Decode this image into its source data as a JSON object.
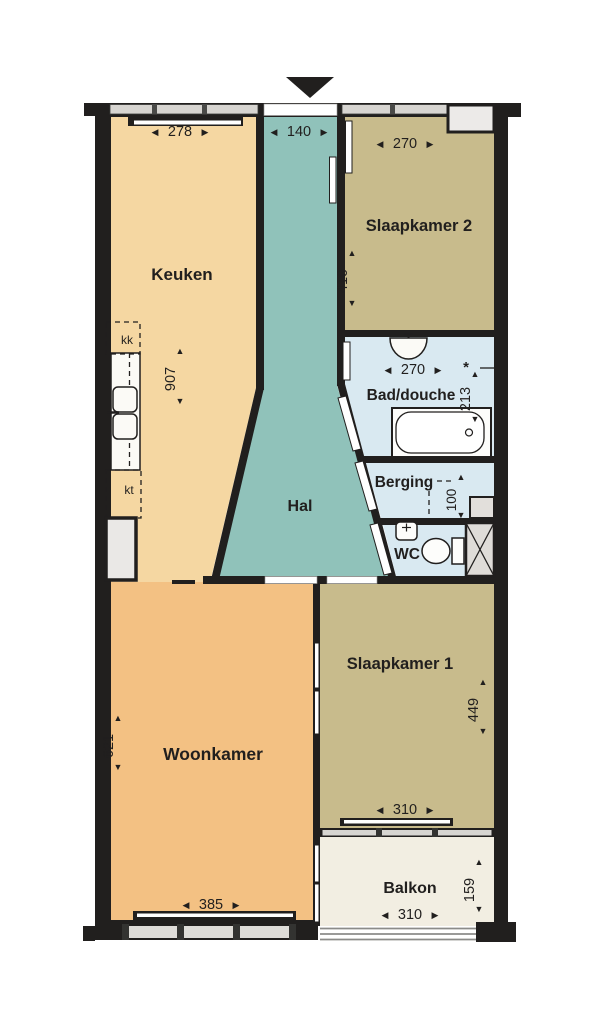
{
  "plan_type": "apartment-floor-plan",
  "arrows": {
    "left": "◀",
    "right": "▶",
    "up": "▲",
    "down": "▼"
  },
  "colors": {
    "wall": "#211f1e",
    "keuken": "#f5d7a2",
    "woonkamer": "#f3c183",
    "slaapkamer": "#c8bb8c",
    "hal": "#90c2ba",
    "wet": "#d9e9f1",
    "balkon": "#f2eee2",
    "window_band": "#d7d5d1",
    "recess": "#eceae8",
    "shaft": "#dfdcd8"
  },
  "rooms": {
    "keuken": {
      "label": "Keuken",
      "width": "278",
      "depth": "907",
      "unit_top": "kk",
      "unit_bottom": "kt"
    },
    "hal": {
      "label": "Hal",
      "width": "140"
    },
    "slaapkamer2": {
      "label": "Slaapkamer 2",
      "width": "270",
      "depth": "410"
    },
    "bad_douche": {
      "label": "Bad/douche",
      "width": "270",
      "depth": "213",
      "note": "*"
    },
    "berging": {
      "label": "Berging",
      "depth": "100"
    },
    "wc": {
      "label": "WC"
    },
    "woonkamer": {
      "label": "Woonkamer",
      "width": "385",
      "depth": "621"
    },
    "slaapkamer1": {
      "label": "Slaapkamer 1",
      "width": "310",
      "depth": "449"
    },
    "balkon": {
      "label": "Balkon",
      "width": "310",
      "depth": "159"
    }
  }
}
